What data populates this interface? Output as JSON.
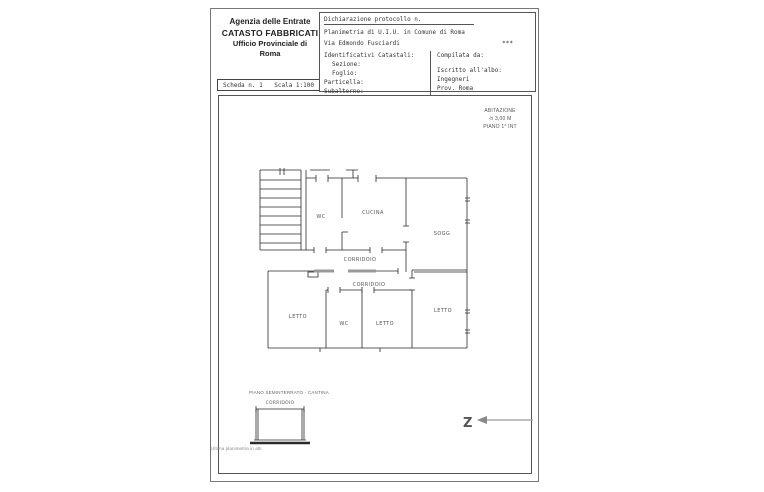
{
  "header": {
    "agency_line1": "Agenzia delle Entrate",
    "agency_line2": "CATASTO FABBRICATI",
    "agency_line3": "Ufficio Provinciale di",
    "agency_line4": "Roma",
    "scheda": "Scheda n. 1",
    "scala": "Scala 1:100",
    "declaration_title": "Dichiarazione protocollo n.",
    "planimetria_line": "Planimetria di U.I.U. in Comune di Roma",
    "address": "Via Edmondo Fusciardi",
    "address_note": "***",
    "catastali_title": "Identificativi Catastali:",
    "sezione": "Sezione:",
    "foglio": "Foglio:",
    "particella": "Particella:",
    "subalterno": "Subalterno:",
    "compilata": "Compilata da:",
    "iscritto": "Iscritto all'albo:",
    "albo": "Ingegneri",
    "prov": "Prov. Roma"
  },
  "annotation": {
    "line1": "ABITAZIONE",
    "line2": "-h 3,00 M",
    "line3": "PIANO 1° INT"
  },
  "plan": {
    "labels": {
      "wc_top": "WC",
      "cucina": "CUCINA",
      "sogg": "SOGG",
      "corridoio_1": "CORRIDOIO",
      "corridoio_2": "CORRIDOIO",
      "letto_left": "LETTO",
      "wc_bottom": "WC",
      "letto_mid": "LETTO",
      "letto_right": "LETTO"
    }
  },
  "basement": {
    "title": "PIANO SEMINTERRATO - CANTINA",
    "label": "CORRIDOIO"
  },
  "compass": {
    "symbol": "Z"
  },
  "footer": {
    "note": "Ultima planimetria in atti"
  },
  "colors": {
    "wall": "#2a2a2a",
    "label": "#555555",
    "threshold": "#999999"
  }
}
